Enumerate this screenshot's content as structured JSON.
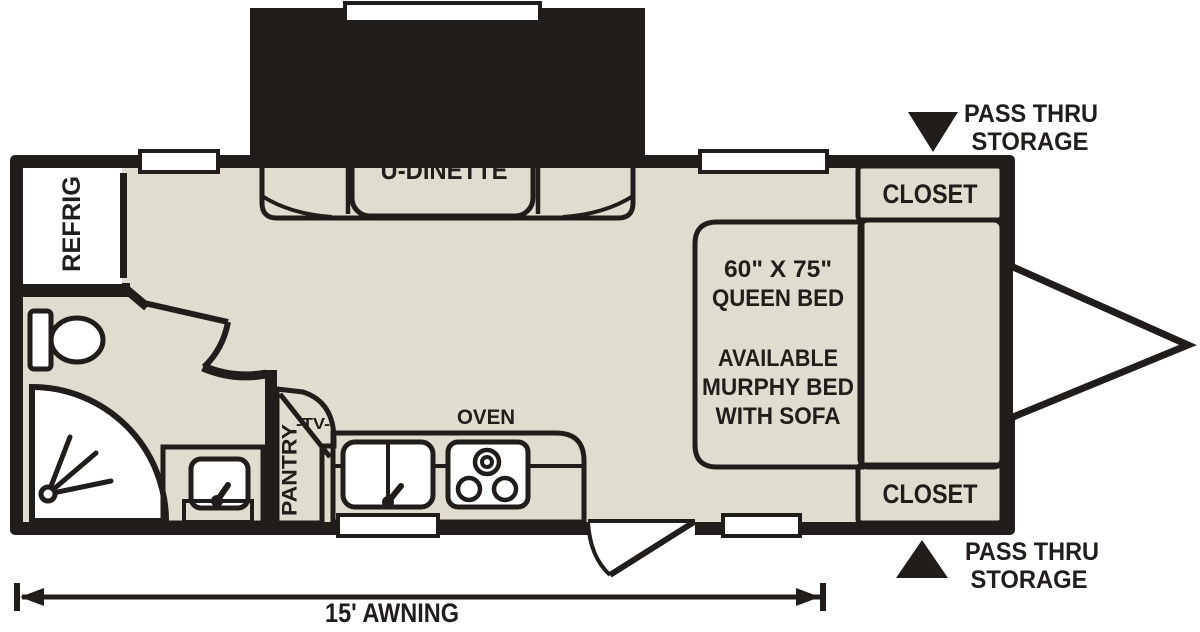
{
  "plan": {
    "labels": {
      "dinette": "U-DINETTE",
      "refrigerator": "REFRIG",
      "pantry": "PANTRY",
      "tv": "-TV-",
      "oven": "OVEN",
      "closet_upper": "CLOSET",
      "closet_lower": "CLOSET",
      "awning": "15' AWNING"
    },
    "bed": {
      "lines": [
        "60\" X 75\"",
        "QUEEN BED",
        "AVAILABLE",
        "MURPHY BED",
        "WITH SOFA"
      ]
    },
    "pass_thru_storage": {
      "line1": "PASS THRU",
      "line2": "STORAGE"
    },
    "colors": {
      "background": "#ffffff",
      "floor": "#e0dcd0",
      "slide_blue": "#6aa6cc",
      "cabinet_brown": "#b2804d",
      "counter_gray": "#8d99a1",
      "wall_black": "#201d1b"
    }
  }
}
